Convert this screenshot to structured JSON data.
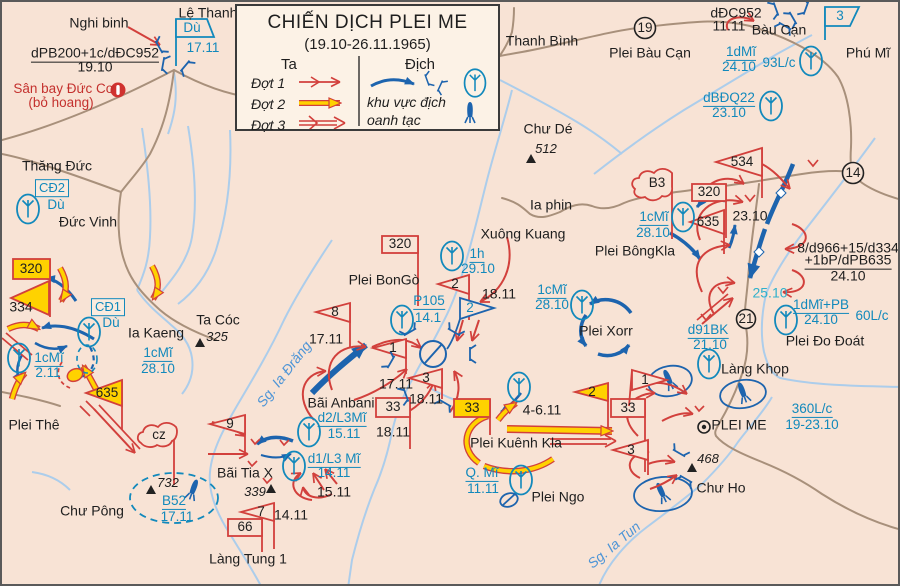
{
  "title": {
    "line1": "CHIẾN DỊCH PLEI ME",
    "line2": "(19.10-26.11.1965)"
  },
  "legend": {
    "ta": "Ta",
    "dich": "Địch",
    "dot1": "Đợt 1",
    "dot2": "Đợt 2",
    "dot3": "Đợt 3",
    "bombing1": "khu vực địch",
    "bombing2": "oanh tạc",
    "icons": [
      "phase-arrow-red",
      "phase-arrow-yellow",
      "phase-arrow-outline",
      "enemy-arrow-blue",
      "enemy-post-icon",
      "airborne-oval-icon",
      "bomb-icon"
    ]
  },
  "colors": {
    "background": "#f8e3d5",
    "friendly_red": "#d2403c",
    "phase2_yellow": "#ffd200",
    "enemy_blue": "#1d64ae",
    "unit_label_blue": "#1289bc",
    "river": "#accdeb",
    "road": "#a8907b",
    "cyan_date": "#2fb0cb"
  },
  "labels": [
    {
      "n": "place-nghi-binh",
      "t": "Nghi binh",
      "x": 97,
      "y": 21,
      "c": "pl"
    },
    {
      "n": "place-le-thanh",
      "t": "Lệ Thanh",
      "x": 206,
      "y": 11,
      "c": "pl"
    },
    {
      "n": "place-thanh-binh",
      "t": "Thanh Bình",
      "x": 540,
      "y": 39,
      "c": "pl"
    },
    {
      "n": "place-plei-bau-can",
      "t": "Plei Bàu Cạn",
      "x": 648,
      "y": 51,
      "c": "pl"
    },
    {
      "n": "place-bau-can",
      "t": "Bàu Cạn",
      "x": 777,
      "y": 28,
      "c": "pl"
    },
    {
      "n": "place-phu-mi",
      "t": "Phú Mĩ",
      "x": 866,
      "y": 51,
      "c": "pl"
    },
    {
      "n": "place-chu-de",
      "t": "Chư Dé",
      "x": 546,
      "y": 127,
      "c": "pl"
    },
    {
      "n": "elev-512",
      "t": "512",
      "x": 544,
      "y": 147,
      "c": "it"
    },
    {
      "n": "place-ia-phin",
      "t": "Ia phin",
      "x": 549,
      "y": 203,
      "c": "pl"
    },
    {
      "n": "place-xuong-kuang",
      "t": "Xuông Kuang",
      "x": 521,
      "y": 232,
      "c": "pl"
    },
    {
      "n": "place-plei-bongo",
      "t": "Plei BonGò",
      "x": 382,
      "y": 278,
      "c": "pl"
    },
    {
      "n": "place-plei-bongkla",
      "t": "Plei BôngKla",
      "x": 633,
      "y": 249,
      "c": "pl"
    },
    {
      "n": "place-plei-xorr",
      "t": "Plei Xorr",
      "x": 604,
      "y": 329,
      "c": "pl"
    },
    {
      "n": "place-plei-do-doat",
      "t": "Plei Đo Đoát",
      "x": 823,
      "y": 339,
      "c": "pl"
    },
    {
      "n": "place-lang-khop",
      "t": "Làng Khọp",
      "x": 753,
      "y": 367,
      "c": "pl"
    },
    {
      "n": "place-plei-me",
      "t": "PLEI ME",
      "x": 737,
      "y": 423,
      "c": "pl"
    },
    {
      "n": "place-chu-ho",
      "t": "Chư Ho",
      "x": 719,
      "y": 486,
      "c": "pl"
    },
    {
      "n": "place-plei-ngo",
      "t": "Plei Ngo",
      "x": 556,
      "y": 495,
      "c": "pl"
    },
    {
      "n": "place-plei-kuenh-kla",
      "t": "Plei Kuênh Kla",
      "x": 514,
      "y": 441,
      "c": "pl"
    },
    {
      "n": "place-bai-anbani",
      "t": "Bãi Anbani",
      "x": 339,
      "y": 401,
      "c": "pl"
    },
    {
      "n": "place-bai-tia-x",
      "t": "Bãi Tia X",
      "x": 243,
      "y": 471,
      "c": "pl"
    },
    {
      "n": "place-chu-pong",
      "t": "Chư Pông",
      "x": 90,
      "y": 509,
      "c": "pl"
    },
    {
      "n": "place-lang-tung-1",
      "t": "Làng Tung 1",
      "x": 246,
      "y": 557,
      "c": "pl"
    },
    {
      "n": "place-plei-the",
      "t": "Plei Thê",
      "x": 32,
      "y": 423,
      "c": "pl"
    },
    {
      "n": "place-ia-kaeng",
      "t": "Ia Kaeng",
      "x": 154,
      "y": 331,
      "c": "pl"
    },
    {
      "n": "place-ta-coc",
      "t": "Ta Cóc",
      "x": 216,
      "y": 318,
      "c": "pl"
    },
    {
      "n": "elev-325",
      "t": "325",
      "x": 215,
      "y": 335,
      "c": "it"
    },
    {
      "n": "place-thang-duc",
      "t": "Thăng Đức",
      "x": 55,
      "y": 164,
      "c": "pl"
    },
    {
      "n": "place-duc-vinh",
      "t": "Đức Vinh",
      "x": 86,
      "y": 220,
      "c": "pl"
    },
    {
      "n": "place-san-bay-duc-co",
      "t": "Sân bay Đức Cơ",
      "x": 62,
      "y": 87,
      "c": "red"
    },
    {
      "n": "place-bo-hoang",
      "t": "(bỏ hoang)",
      "x": 59,
      "y": 101,
      "c": "red"
    },
    {
      "n": "unit-dpb200",
      "t": "dPB200+1c/dĐC952",
      "x": 93,
      "y": 52,
      "c": "blk u"
    },
    {
      "n": "date-dpb200",
      "t": "19.10",
      "x": 93,
      "y": 65,
      "c": "blk"
    },
    {
      "n": "unit-ddc952",
      "t": "dĐC952",
      "x": 734,
      "y": 11,
      "c": "blk"
    },
    {
      "n": "date-ddc952",
      "t": "11.11",
      "x": 727,
      "y": 24,
      "c": "blk"
    },
    {
      "n": "unit-d966-line1",
      "t": "8/d966+15/d334",
      "x": 846,
      "y": 246,
      "c": "blk"
    },
    {
      "n": "unit-d966-line2",
      "t": "+1bP/dPB635",
      "x": 846,
      "y": 259,
      "c": "blk u"
    },
    {
      "n": "date-d966",
      "t": "24.10",
      "x": 846,
      "y": 274,
      "c": "blk"
    },
    {
      "n": "unit-334",
      "t": "334",
      "x": 19,
      "y": 305,
      "c": "blk"
    },
    {
      "n": "date-2310",
      "t": "23.10",
      "x": 748,
      "y": 214,
      "c": "blk"
    },
    {
      "n": "date-1811-a",
      "t": "18.11",
      "x": 497,
      "y": 292,
      "c": "blk"
    },
    {
      "n": "date-1811-b",
      "t": "18.11",
      "x": 424,
      "y": 397,
      "c": "blk"
    },
    {
      "n": "date-1811-c",
      "t": "18.11",
      "x": 391,
      "y": 430,
      "c": "blk"
    },
    {
      "n": "date-1711-a",
      "t": "17.11",
      "x": 324,
      "y": 337,
      "c": "blk"
    },
    {
      "n": "date-1711-b",
      "t": "17.11",
      "x": 394,
      "y": 382,
      "c": "blk"
    },
    {
      "n": "date-1411",
      "t": "14.11",
      "x": 289,
      "y": 513,
      "c": "blk"
    },
    {
      "n": "date-1511",
      "t": "15.11",
      "x": 332,
      "y": 490,
      "c": "blk"
    },
    {
      "n": "date-4611",
      "t": "4-6.11",
      "x": 540,
      "y": 408,
      "c": "blk"
    },
    {
      "n": "date-2510",
      "t": "25.10",
      "x": 768,
      "y": 291,
      "c": "cyan"
    },
    {
      "n": "flag-du-lethanh",
      "t": "Dù",
      "x": 190,
      "y": 26,
      "c": "fnum-b"
    },
    {
      "n": "date-du-lethanh",
      "t": "17.11",
      "x": 201,
      "y": 46,
      "c": "blu"
    },
    {
      "n": "unit-1dmi",
      "t": "1dMĩ",
      "x": 739,
      "y": 51,
      "c": "blu u"
    },
    {
      "n": "date-1dmi",
      "t": "24.10",
      "x": 737,
      "y": 65,
      "c": "blu"
    },
    {
      "n": "unit-93lc",
      "t": "93L/c",
      "x": 777,
      "y": 61,
      "c": "blu"
    },
    {
      "n": "unit-dbdq22",
      "t": "dBĐQ22",
      "x": 727,
      "y": 97,
      "c": "blu u"
    },
    {
      "n": "date-dbdq22",
      "t": "23.10",
      "x": 727,
      "y": 111,
      "c": "blu"
    },
    {
      "n": "unit-1cmi-a",
      "t": "1cMĩ",
      "x": 652,
      "y": 216,
      "c": "blu u"
    },
    {
      "n": "date-1cmi-a",
      "t": "28.10",
      "x": 651,
      "y": 231,
      "c": "blu"
    },
    {
      "n": "unit-1cmi-b",
      "t": "1cMĩ",
      "x": 550,
      "y": 289,
      "c": "blu u"
    },
    {
      "n": "date-1cmi-b",
      "t": "28.10",
      "x": 550,
      "y": 303,
      "c": "blu"
    },
    {
      "n": "unit-1cmi-c",
      "t": "1cMĩ",
      "x": 156,
      "y": 352,
      "c": "blu u"
    },
    {
      "n": "date-1cmi-c",
      "t": "28.10",
      "x": 156,
      "y": 367,
      "c": "blu"
    },
    {
      "n": "unit-1cmi-d",
      "t": "1cMĩ",
      "x": 47,
      "y": 357,
      "c": "blu u"
    },
    {
      "n": "date-1cmi-d",
      "t": "2.11",
      "x": 46,
      "y": 371,
      "c": "blu"
    },
    {
      "n": "unit-p105",
      "t": "P105",
      "x": 427,
      "y": 300,
      "c": "blu u"
    },
    {
      "n": "date-p105",
      "t": "14.1",
      "x": 426,
      "y": 316,
      "c": "blu"
    },
    {
      "n": "unit-1h",
      "t": "1h",
      "x": 475,
      "y": 253,
      "c": "blu u"
    },
    {
      "n": "date-1h",
      "t": "29.10",
      "x": 476,
      "y": 267,
      "c": "blu"
    },
    {
      "n": "unit-d91bk",
      "t": "d91BK",
      "x": 706,
      "y": 329,
      "c": "blu u"
    },
    {
      "n": "date-d91bk",
      "t": "21.10",
      "x": 708,
      "y": 343,
      "c": "blu"
    },
    {
      "n": "unit-1dmipb",
      "t": "1dMĩ+PB",
      "x": 819,
      "y": 304,
      "c": "blu u"
    },
    {
      "n": "date-1dmipb",
      "t": "24.10",
      "x": 819,
      "y": 318,
      "c": "blu"
    },
    {
      "n": "unit-60lc",
      "t": "60L/c",
      "x": 870,
      "y": 314,
      "c": "blu"
    },
    {
      "n": "unit-360lc",
      "t": "360L/c",
      "x": 810,
      "y": 408,
      "c": "blu u"
    },
    {
      "n": "date-360lc",
      "t": "19-23.10",
      "x": 810,
      "y": 423,
      "c": "blu"
    },
    {
      "n": "unit-qmi",
      "t": "Q. Mĩ",
      "x": 480,
      "y": 472,
      "c": "blu u"
    },
    {
      "n": "date-qmi",
      "t": "11.11",
      "x": 481,
      "y": 487,
      "c": "blu"
    },
    {
      "n": "unit-d2l3",
      "t": "d2/L3Mĩ",
      "x": 340,
      "y": 417,
      "c": "blu u"
    },
    {
      "n": "date-d2l3",
      "t": "15.11",
      "x": 342,
      "y": 432,
      "c": "blu"
    },
    {
      "n": "unit-d1l3",
      "t": "d1/L3 Mĩ",
      "x": 332,
      "y": 458,
      "c": "blu u"
    },
    {
      "n": "date-d1l3",
      "t": "14.11",
      "x": 332,
      "y": 471,
      "c": "blu"
    },
    {
      "n": "unit-b52",
      "t": "B52",
      "x": 172,
      "y": 500,
      "c": "blu u"
    },
    {
      "n": "date-b52",
      "t": "17.11",
      "x": 175,
      "y": 515,
      "c": "blu"
    },
    {
      "n": "unit-cd1",
      "t": "CĐ1",
      "x": 106,
      "y": 305,
      "c": "boxb"
    },
    {
      "n": "unit-cd1-du",
      "t": "Dù",
      "x": 109,
      "y": 321,
      "c": "blu"
    },
    {
      "n": "unit-cd2",
      "t": "CĐ2",
      "x": 50,
      "y": 186,
      "c": "boxb"
    },
    {
      "n": "unit-cd2-du",
      "t": "Dù",
      "x": 54,
      "y": 203,
      "c": "blu"
    },
    {
      "n": "elev-339",
      "t": "339",
      "x": 253,
      "y": 490,
      "c": "it"
    },
    {
      "n": "elev-732",
      "t": "732",
      "x": 166,
      "y": 481,
      "c": "it"
    },
    {
      "n": "elev-468",
      "t": "468",
      "x": 706,
      "y": 457,
      "c": "it"
    },
    {
      "n": "river-ia-drang",
      "t": "Sg. Ia Đrăng",
      "x": 282,
      "y": 372,
      "c": "riv",
      "r": -52
    },
    {
      "n": "river-ia-tun",
      "t": "Sg. Ia Tun",
      "x": 612,
      "y": 543,
      "c": "riv",
      "r": -40
    },
    {
      "n": "flag-534",
      "t": "534",
      "x": 740,
      "y": 160,
      "c": "fnum"
    },
    {
      "n": "flag-320-ne",
      "t": "320",
      "x": 707,
      "y": 190,
      "c": "fnum"
    },
    {
      "n": "flag-635-ne",
      "t": "635",
      "x": 706,
      "y": 220,
      "c": "fnum"
    },
    {
      "n": "flag-b3",
      "t": "B3",
      "x": 655,
      "y": 181,
      "c": "fnum"
    },
    {
      "n": "flag-320-center",
      "t": "320",
      "x": 398,
      "y": 242,
      "c": "fnum"
    },
    {
      "n": "flag-8",
      "t": "8",
      "x": 333,
      "y": 310,
      "c": "fnum"
    },
    {
      "n": "flag-2-red",
      "t": "2",
      "x": 453,
      "y": 282,
      "c": "fnum"
    },
    {
      "n": "flag-2-blue",
      "t": "2",
      "x": 468,
      "y": 306,
      "c": "fnum-b"
    },
    {
      "n": "flag-1-a",
      "t": "1",
      "x": 391,
      "y": 346,
      "c": "fnum"
    },
    {
      "n": "flag-3-a",
      "t": "3",
      "x": 424,
      "y": 376,
      "c": "fnum"
    },
    {
      "n": "flag-33-a",
      "t": "33",
      "x": 391,
      "y": 405,
      "c": "fnum"
    },
    {
      "n": "flag-33-yellow",
      "t": "33",
      "x": 470,
      "y": 406,
      "c": "fnum"
    },
    {
      "n": "flag-33-b",
      "t": "33",
      "x": 626,
      "y": 406,
      "c": "fnum"
    },
    {
      "n": "flag-2-yellow",
      "t": "2",
      "x": 590,
      "y": 390,
      "c": "fnum"
    },
    {
      "n": "flag-1-b",
      "t": "1",
      "x": 643,
      "y": 378,
      "c": "fnum"
    },
    {
      "n": "flag-3-b",
      "t": "3",
      "x": 629,
      "y": 448,
      "c": "fnum"
    },
    {
      "n": "flag-9",
      "t": "9",
      "x": 228,
      "y": 422,
      "c": "fnum"
    },
    {
      "n": "flag-7",
      "t": "7",
      "x": 259,
      "y": 510,
      "c": "fnum"
    },
    {
      "n": "flag-66",
      "t": "66",
      "x": 243,
      "y": 525,
      "c": "fnum"
    },
    {
      "n": "flag-320-west",
      "t": "320",
      "x": 29,
      "y": 267,
      "c": "fnum"
    },
    {
      "n": "flag-635-west",
      "t": "635",
      "x": 105,
      "y": 391,
      "c": "fnum"
    },
    {
      "n": "flag-cz",
      "t": "cz",
      "x": 157,
      "y": 433,
      "c": "fnum"
    },
    {
      "n": "flag-3-blue",
      "t": "3",
      "x": 838,
      "y": 14,
      "c": "fnum-b"
    },
    {
      "n": "road-number-19",
      "t": "19",
      "x": 643,
      "y": 26,
      "c": "fnum"
    },
    {
      "n": "road-number-14",
      "t": "14",
      "x": 851,
      "y": 171,
      "c": "fnum"
    },
    {
      "n": "road-number-21",
      "t": "21",
      "x": 744,
      "y": 317,
      "c": "fnum"
    }
  ]
}
